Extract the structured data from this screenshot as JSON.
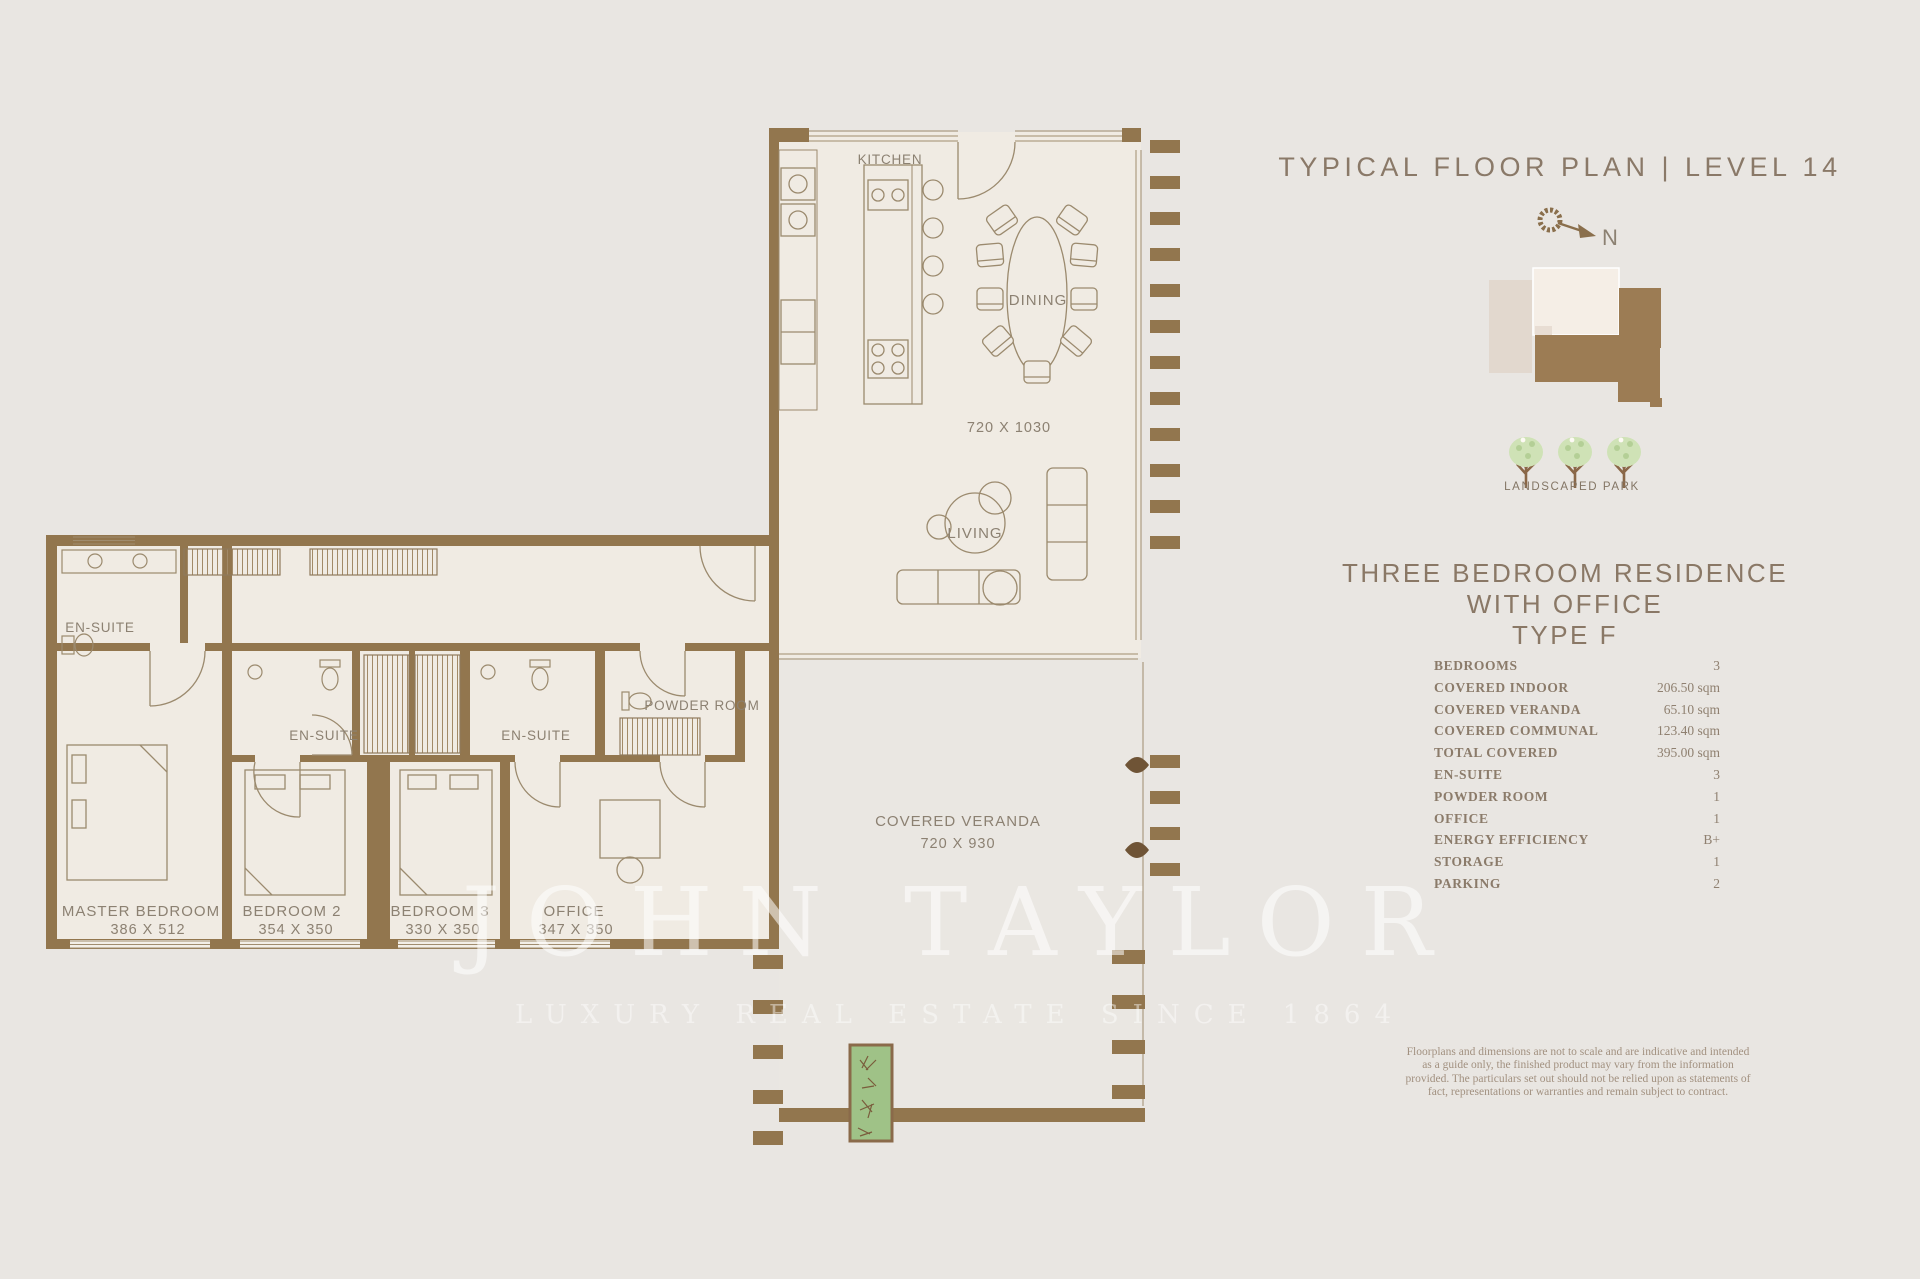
{
  "page": {
    "background": "#e9e6e2"
  },
  "right_panel": {
    "title": "TYPICAL FLOOR PLAN | LEVEL 14",
    "compass_label": "N",
    "keyplan_caption": "LANDSCAPED PARK",
    "heading_line1": "THREE BEDROOM RESIDENCE WITH OFFICE",
    "heading_line2": "TYPE F",
    "specs": [
      {
        "label": "BEDROOMS",
        "value": "3"
      },
      {
        "label": "COVERED INDOOR",
        "value": "206.50 sqm"
      },
      {
        "label": "COVERED VERANDA",
        "value": "65.10 sqm"
      },
      {
        "label": "COVERED COMMUNAL",
        "value": "123.40 sqm"
      },
      {
        "label": "TOTAL COVERED",
        "value": "395.00 sqm"
      },
      {
        "label": "EN-SUITE",
        "value": "3"
      },
      {
        "label": "POWDER ROOM",
        "value": "1"
      },
      {
        "label": "OFFICE",
        "value": "1"
      },
      {
        "label": "ENERGY EFFICIENCY",
        "value": "B+"
      },
      {
        "label": "STORAGE",
        "value": "1"
      },
      {
        "label": "PARKING",
        "value": "2"
      }
    ],
    "disclaimer": "Floorplans and dimensions are not to scale and are indicative and intended as a guide only, the finished product may vary from the information provided. The particulars set out should not be relied upon as statements of fact, representations or warranties and remain subject to contract."
  },
  "floor_plan": {
    "rooms": {
      "kitchen": {
        "label": "KITCHEN"
      },
      "dining": {
        "label": "DINING",
        "dimensions": "720 X 1030"
      },
      "living": {
        "label": "LIVING"
      },
      "covered_veranda": {
        "label": "COVERED VERANDA",
        "dimensions": "720 X 930"
      },
      "powder_room": {
        "label": "POWDER ROOM"
      },
      "ensuite_master": {
        "label": "EN-SUITE"
      },
      "ensuite_2": {
        "label": "EN-SUITE"
      },
      "ensuite_3": {
        "label": "EN-SUITE"
      },
      "master_bedroom": {
        "label": "MASTER BEDROOM",
        "dimensions": "386 X 512"
      },
      "bedroom_2": {
        "label": "BEDROOM 2",
        "dimensions": "354 X 350"
      },
      "bedroom_3": {
        "label": "BEDROOM 3",
        "dimensions": "330 X 350"
      },
      "office": {
        "label": "OFFICE",
        "dimensions": "347 X 350"
      }
    }
  },
  "watermark": {
    "name": "JOHN TAYLOR",
    "tagline": "LUXURY REAL ESTATE SINCE 1864"
  },
  "colors": {
    "background": "#e9e6e2",
    "wall_brown": "#92764e",
    "floor_cream": "#f0ebe3",
    "line_brown": "#a08c6e",
    "text_brown": "#8a7968",
    "tree_green": "#cfe2b6",
    "planter_green": "#9fc287"
  }
}
